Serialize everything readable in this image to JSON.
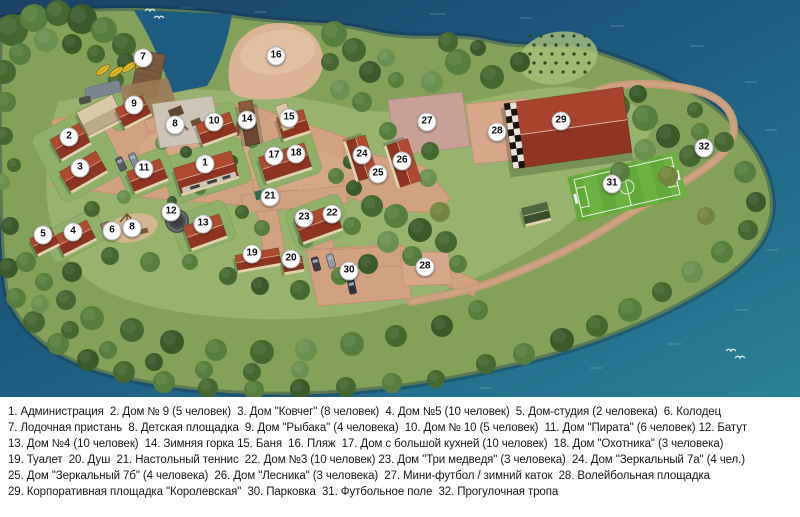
{
  "map": {
    "colors": {
      "water": "#1d5a80",
      "grass": "#83a159",
      "clearing": "#9db974",
      "path": "#d1a180",
      "roof_red": "#a3402b",
      "sand": "#dcb394",
      "football_green": "#61a93a",
      "marker_bg": "#ffffff",
      "marker_text": "#0d0d0d"
    },
    "markers": [
      {
        "n": "1",
        "x": 205,
        "y": 164
      },
      {
        "n": "2",
        "x": 69,
        "y": 137
      },
      {
        "n": "3",
        "x": 80,
        "y": 168
      },
      {
        "n": "4",
        "x": 73,
        "y": 232
      },
      {
        "n": "5",
        "x": 43,
        "y": 235
      },
      {
        "n": "6",
        "x": 112,
        "y": 231
      },
      {
        "n": "7",
        "x": 143,
        "y": 58
      },
      {
        "n": "8",
        "x": 175,
        "y": 125
      },
      {
        "n": "8",
        "x": 132,
        "y": 228
      },
      {
        "n": "9",
        "x": 134,
        "y": 105
      },
      {
        "n": "10",
        "x": 214,
        "y": 122
      },
      {
        "n": "11",
        "x": 144,
        "y": 169
      },
      {
        "n": "12",
        "x": 171,
        "y": 212
      },
      {
        "n": "13",
        "x": 203,
        "y": 224
      },
      {
        "n": "14",
        "x": 247,
        "y": 120
      },
      {
        "n": "15",
        "x": 289,
        "y": 118
      },
      {
        "n": "16",
        "x": 276,
        "y": 56
      },
      {
        "n": "17",
        "x": 274,
        "y": 156
      },
      {
        "n": "18",
        "x": 296,
        "y": 154
      },
      {
        "n": "19",
        "x": 252,
        "y": 254
      },
      {
        "n": "20",
        "x": 291,
        "y": 259
      },
      {
        "n": "21",
        "x": 270,
        "y": 197
      },
      {
        "n": "22",
        "x": 332,
        "y": 214
      },
      {
        "n": "23",
        "x": 304,
        "y": 218
      },
      {
        "n": "24",
        "x": 362,
        "y": 155
      },
      {
        "n": "25",
        "x": 378,
        "y": 174
      },
      {
        "n": "26",
        "x": 402,
        "y": 161
      },
      {
        "n": "27",
        "x": 427,
        "y": 122
      },
      {
        "n": "28",
        "x": 497,
        "y": 132
      },
      {
        "n": "28",
        "x": 425,
        "y": 267
      },
      {
        "n": "29",
        "x": 561,
        "y": 121
      },
      {
        "n": "30",
        "x": 349,
        "y": 271
      },
      {
        "n": "31",
        "x": 612,
        "y": 184
      },
      {
        "n": "32",
        "x": 704,
        "y": 148
      }
    ]
  },
  "legend": {
    "lines": [
      "1. Администрация  2. Дом № 9 (5 человек)  3. Дом \"Ковчег\" (8 человек)  4. Дом №5 (10 человек)  5. Дом-студия (2 человека)  6. Колодец",
      "7. Лодочная пристань  8. Детская площадка  9. Дом \"Рыбака\" (4 человека)  10. Дом № 10 (5 человек)  11. Дом \"Пирата\" (6 человек) 12. Батут",
      "13. Дом №4 (10 человек)  14. Зимняя горка 15. Баня  16. Пляж  17. Дом с большой кухней (10 человек)  18. Дом \"Охотника\" (3 человека)",
      "19. Туалет  20. Душ  21. Настольный теннис  22. Дом №3 (10 человек) 23. Дом \"Три медведя\" (3 человека)  24. Дом \"Зеркальный 7а\" (4 чел.)",
      "25. Дом \"Зеркальный 7б\" (4 человека)  26. Дом \"Лесника\" (3 человека)  27. Мини-футбол / зимний каток  28. Волейбольная площадка",
      "29. Корпоративная площадка \"Королевская\"  30. Парковка  31. Футбольное поле  32. Прогулочная тропа"
    ]
  }
}
